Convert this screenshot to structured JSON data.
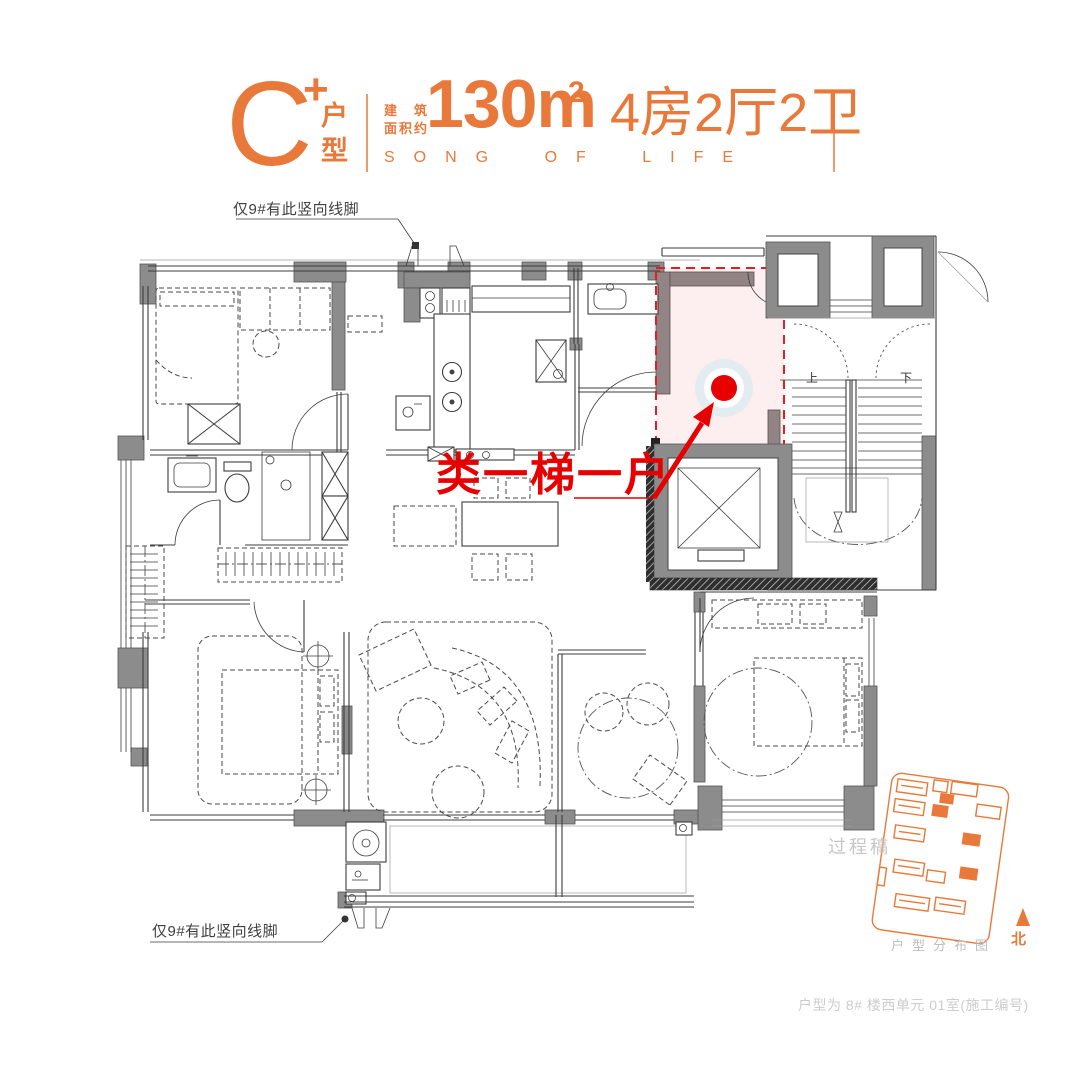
{
  "header": {
    "type_letter": "C",
    "type_plus": "+",
    "type_vertical": [
      "户",
      "型"
    ],
    "area_prefix_line1": "建筑",
    "area_prefix_line2": "面积约",
    "area_value": "130m",
    "area_superscript": "2",
    "layout_summary": "4房2厅2卫",
    "slogan": "SONG OF LIFE",
    "accent_color": "#E8793A"
  },
  "floor_plan": {
    "note_top": "仅9#有此竖向线脚",
    "note_bottom": "仅9#有此竖向线脚",
    "highlight_label": "类一梯一户",
    "highlight_color": "#E60000",
    "stair_up_label": "上",
    "stair_down_label": "下",
    "wall_color": "#8C8C8C"
  },
  "legend": {
    "draft_watermark": "过程稿",
    "sitemap_caption": "户型分布图",
    "north_label": "北"
  },
  "footer": {
    "caption": "户型为 8# 楼西单元 01室(施工编号)"
  }
}
